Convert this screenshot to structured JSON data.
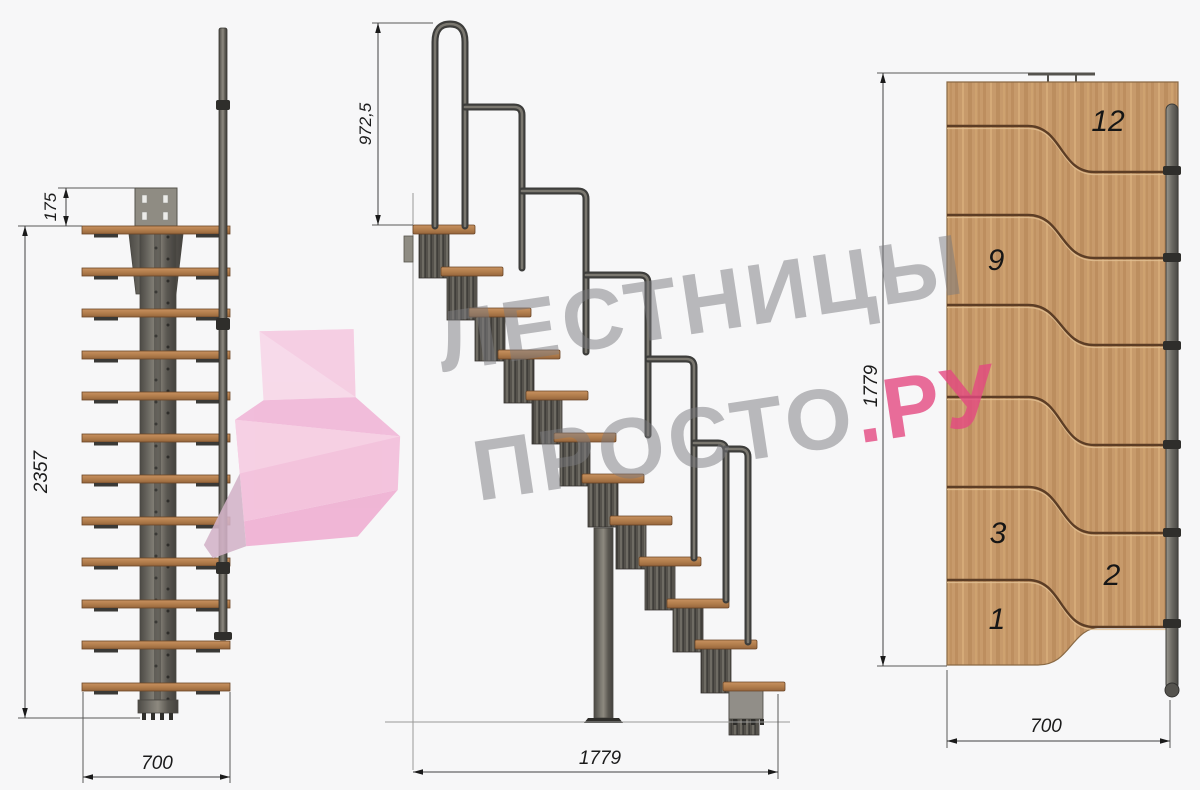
{
  "watermark": {
    "brand_line1": "ЛЕСТНИЦЫ",
    "brand_line2": "ПРОСТО",
    "brand_suffix": ".РУ"
  },
  "views": {
    "front": {
      "dims": {
        "plate_offset": "175",
        "total_height": "2357",
        "width": "700"
      }
    },
    "side": {
      "dims": {
        "handrail_height": "972,5",
        "length": "1779"
      }
    },
    "plan": {
      "dims": {
        "length": "1779",
        "width": "700"
      },
      "step_numbers": [
        {
          "label": "12"
        },
        {
          "label": "9"
        },
        {
          "label": "3"
        },
        {
          "label": "2"
        },
        {
          "label": "1"
        }
      ]
    }
  },
  "colors": {
    "accent_pink": "#e5578a",
    "watermark_gray": "#7b7b7e",
    "wood": "#c79a6b",
    "metal": "#55534e",
    "dim_line": "#424242"
  }
}
